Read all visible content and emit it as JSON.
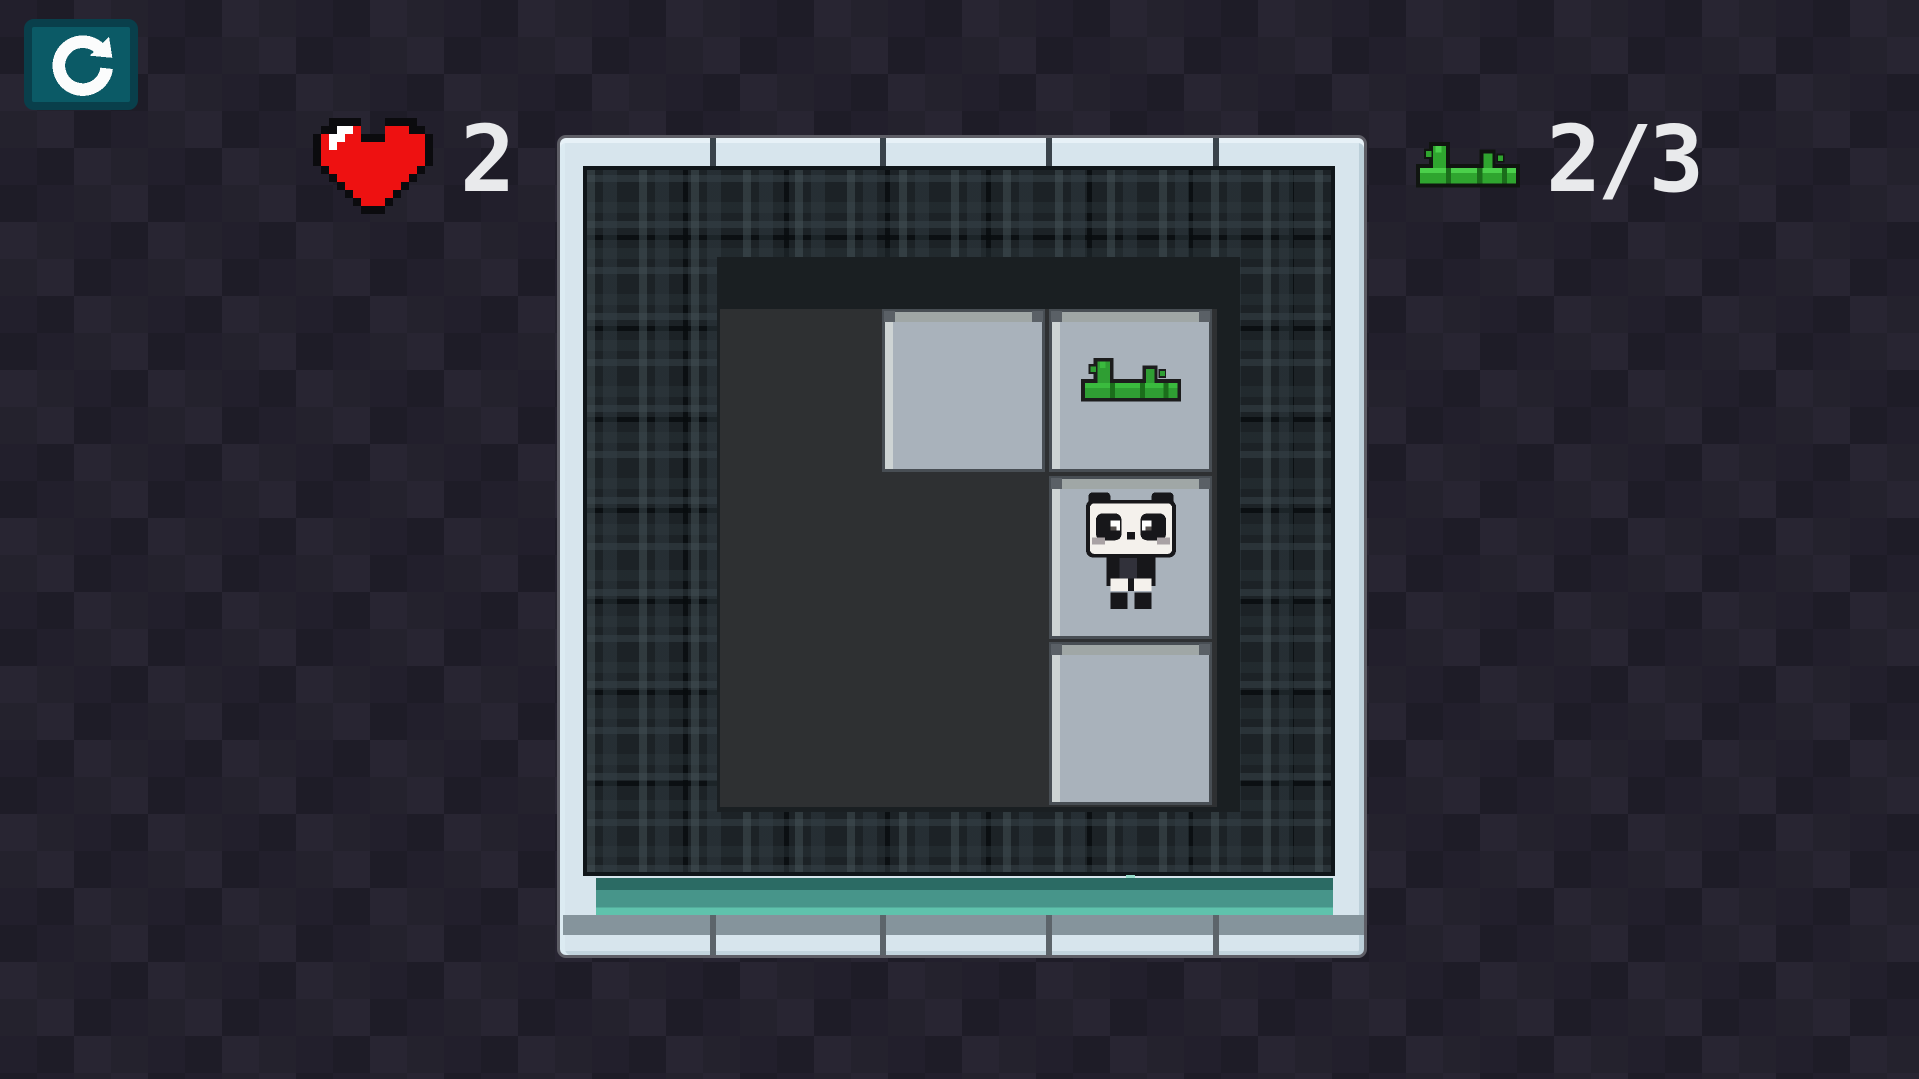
{
  "hud": {
    "restart": {
      "icon": "restart-icon"
    },
    "lives": {
      "icon": "heart-icon",
      "count": "2"
    },
    "bamboo": {
      "icon": "bamboo-icon",
      "count": "2/3"
    }
  },
  "board": {
    "grid_rows": 3,
    "grid_cols": 3,
    "tiles": [
      {
        "row": 0,
        "col": 1,
        "item": null
      },
      {
        "row": 0,
        "col": 2,
        "item": "bamboo"
      },
      {
        "row": 1,
        "col": 2,
        "item": "panda"
      },
      {
        "row": 2,
        "col": 2,
        "item": null
      }
    ]
  },
  "colors": {
    "background": "#221f2c",
    "button_teal": "#0b5a66",
    "button_border": "#093f4b",
    "heart_red": "#ee1111",
    "bamboo_green": "#2fa52f",
    "frame_light": "#d7e5ed",
    "frame_circuit_dark": "#1c2226",
    "play_area_dark": "#1a1f22",
    "floor_dark": "#2e3032",
    "tile_gray": "#a9b2bb",
    "bar_teal": "#47958a",
    "hud_text": "#e9eaec"
  }
}
